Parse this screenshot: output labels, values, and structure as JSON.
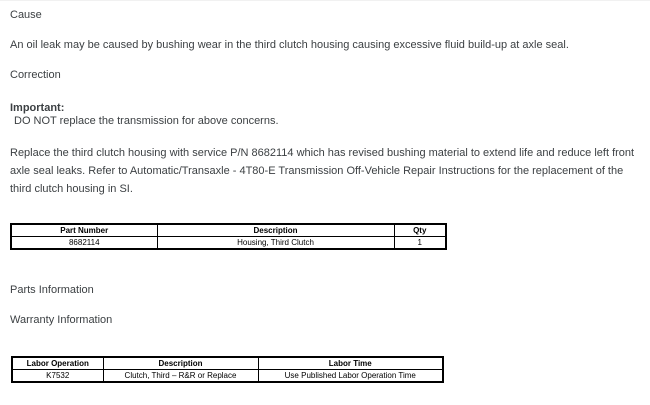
{
  "document": {
    "cause": {
      "heading": "Cause",
      "body": "An oil leak may be caused by bushing wear in the third clutch housing causing excessive fluid build-up at axle seal."
    },
    "correction": {
      "heading": "Correction",
      "important_label": "Important:",
      "important_text": "DO NOT replace the transmission for above concerns.",
      "body": "Replace the third clutch housing with service P/N 8682114 which has revised bushing material to extend life and reduce left front axle seal leaks. Refer to Automatic/Transaxle - 4T80-E Transmission Off-Vehicle Repair Instructions for the replacement of the third clutch housing in SI."
    },
    "parts_table": {
      "headers": [
        "Part Number",
        "Description",
        "Qty"
      ],
      "rows": [
        {
          "part_number": "8682114",
          "description": "Housing, Third Clutch",
          "qty": "1"
        }
      ]
    },
    "parts_heading": "Parts Information",
    "warranty_heading": "Warranty Information",
    "labor_table": {
      "headers": [
        "Labor Operation",
        "Description",
        "Labor Time"
      ],
      "rows": [
        {
          "labor_operation": "K7532",
          "description": "Clutch, Third – R&R or Replace",
          "labor_time": "Use Published Labor Operation Time"
        }
      ]
    },
    "colors": {
      "text": "#3c4043",
      "table_text": "#000000",
      "table_border": "#000000",
      "background": "#ffffff"
    }
  }
}
